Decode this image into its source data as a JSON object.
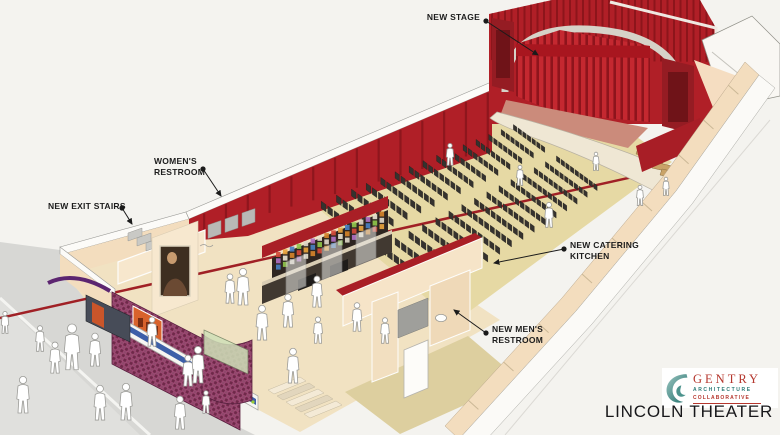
{
  "annotations": {
    "new_stage": "NEW STAGE",
    "womens_restroom": "WOMEN'S\nRESTROOM",
    "new_exit_stairs": "NEW EXIT STAIRS",
    "new_catering_kitchen": "NEW CATERING\nKITCHEN",
    "new_mens_restroom": "NEW MEN'S\nRESTROOM"
  },
  "logo": {
    "name": "GENTRY",
    "line1": "ARCHITECTURE",
    "line2": "COLLABORATIVE"
  },
  "title": "LINCOLN THEATER",
  "colors": {
    "wall_red": "#b01f27",
    "wall_red_dark": "#8e161d",
    "curtain_red": "#c42830",
    "floor_tan": "#e6d9a4",
    "lobby_cream": "#f1e2c2",
    "wall_cream": "#f3ddbe",
    "facade_maroon": "#6e2949",
    "marquee_blue": "#3d5fa8",
    "awning_purple": "#5c2570",
    "stage_salmon": "#cb8b7b",
    "seat_black": "#35322e",
    "sidewalk_gray": "#d7d7d4",
    "logo_teal": "#2c7a76",
    "logo_red": "#b5372e"
  }
}
